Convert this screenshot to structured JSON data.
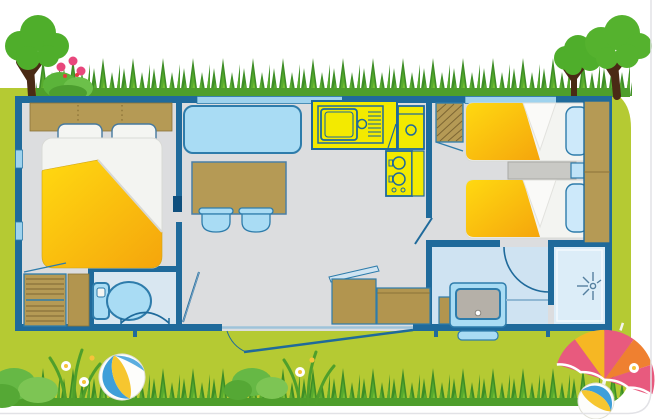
{
  "illustration": {
    "subject": "mobile-home-floorplan-illustration",
    "palette": {
      "lawn": "#b5ca33",
      "grass_dark": "#3e8e26",
      "grass_mid": "#58ab2e",
      "grass_light": "#76bd33",
      "grass_base": "#4e9e2b",
      "wall_blue": "#1f6a9b",
      "floor_gray": "#dcdddf",
      "wet_floor_blue": "#cfe3f2",
      "shower_floor": "#dcedf8",
      "furniture_wood": "#b59a55",
      "upholstery_blue": "#a9dcf4",
      "upholstery_outline": "#2e7cab",
      "kitchen_yellow": "#f3ea00",
      "blanket_yellow_light": "#ffd911",
      "blanket_yellow_dark": "#f5a50c",
      "sheet_white": "#f3f4f1",
      "trunk_brown": "#4a2a15",
      "foliage_green": "#4fae2b",
      "flower_pink": "#e8477c",
      "parasol_pink": "#e85a7e",
      "parasol_yellow": "#f6b723",
      "parasol_orange": "#ef8030",
      "ball_blue": "#3e9fd9",
      "ball_yellow": "#f6c62f",
      "card_border": "#e2e2e6"
    },
    "outdoor_elements": [
      "tree-left",
      "flower-bush",
      "tree-right-small",
      "tree-right-large",
      "top-grass-hedge",
      "bottom-grass-hedge",
      "bush-bottom-left",
      "daisy-flowers",
      "beach-ball-large",
      "bush-bottom-center",
      "grass-clumps",
      "parasol",
      "beach-ball-small"
    ],
    "rooms": [
      {
        "name": "master-bedroom",
        "furniture": [
          "headboard-shelf",
          "pillow-left",
          "pillow-right",
          "double-bed",
          "slatted-wardrobe",
          "bath-mat"
        ]
      },
      {
        "name": "wc",
        "furniture": [
          "toilet"
        ]
      },
      {
        "name": "living-room",
        "furniture": [
          "sofa-bench",
          "dining-table",
          "chair-1",
          "chair-2",
          "storage-chest-open-lid",
          "storage-chest",
          "entry-step"
        ]
      },
      {
        "name": "kitchen",
        "furniture": [
          "sink-counter",
          "drainer",
          "upper-cabinet",
          "stove-two-burners",
          "side-counter"
        ]
      },
      {
        "name": "bathroom",
        "furniture": [
          "laundry-box",
          "washbasin",
          "shower-cubicle",
          "shower-spray-icon"
        ]
      },
      {
        "name": "twin-bedroom",
        "furniture": [
          "slatted-closet",
          "single-bed-top",
          "single-bed-bottom",
          "bed-pillows",
          "nightstand",
          "tall-wardrobe"
        ]
      }
    ],
    "openings": [
      "entrance-door",
      "wc-door-arc",
      "living-wc-door",
      "sliding-door-marker",
      "twin-bedroom-door",
      "bathroom-door-arc",
      "window-left-wall-upper",
      "window-left-wall-lower",
      "window-above-sofa",
      "window-twin-bedroom"
    ]
  }
}
